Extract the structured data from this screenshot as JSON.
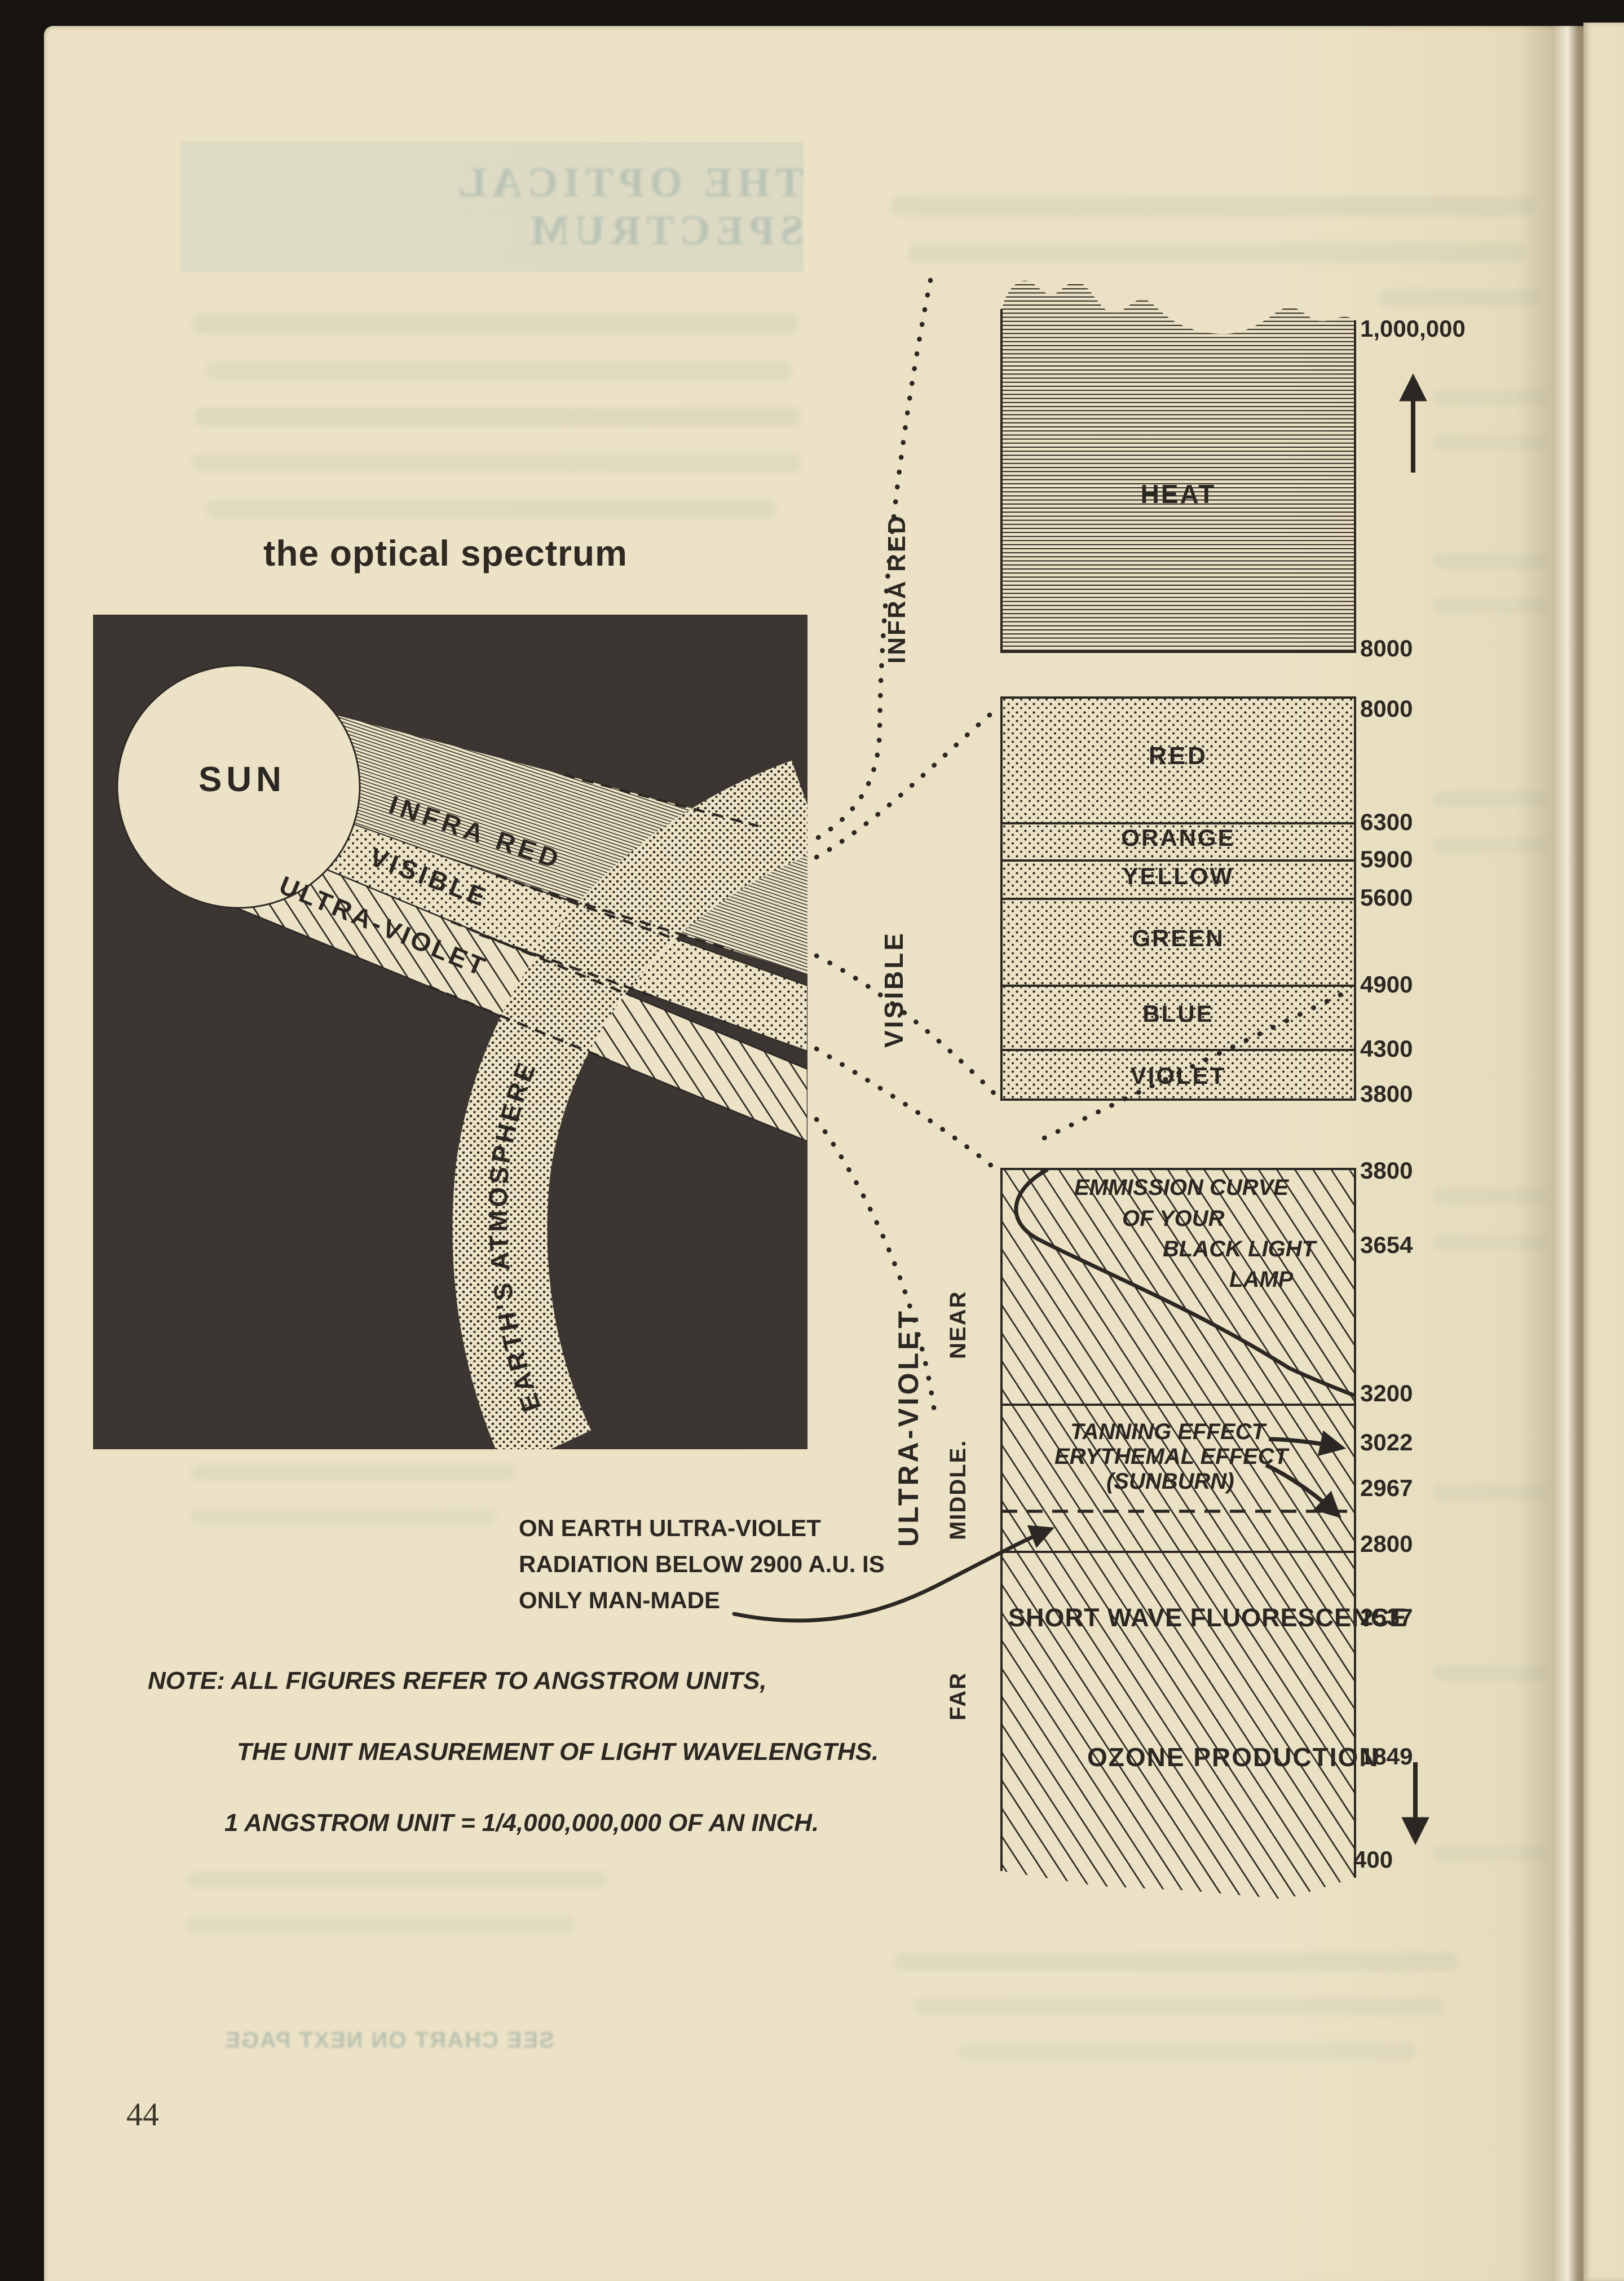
{
  "page": {
    "number": "44",
    "title": "the optical spectrum",
    "bleed_title": "THE OPTICAL SPECTRUM",
    "bleed_footer": "SEE CHART ON NEXT PAGE"
  },
  "diagram": {
    "sun": "SUN",
    "infra_red": "INFRA RED",
    "visible": "VISIBLE",
    "ultra_violet": "ULTRA-VIOLET",
    "atmosphere": "EARTH'S ATMOSPHERE"
  },
  "chart": {
    "heat_label": "HEAT",
    "side_labels": {
      "infra_red": "INFRA RED",
      "visible": "VISIBLE",
      "ultra_violet": "ULTRA-VIOLET",
      "near": "NEAR",
      "middle": "MIDDLE.",
      "far": "FAR"
    },
    "color_labels": [
      "RED",
      "ORANGE",
      "YELLOW",
      "GREEN",
      "BLUE",
      "VIOLET"
    ],
    "emission_curve_lines": [
      "EMMISSION CURVE",
      "OF YOUR",
      "BLACK LIGHT",
      "LAMP"
    ],
    "tanning_label": "TANNING EFFECT",
    "erythemal_label": "ERYTHEMAL EFFECT",
    "sunburn_label": "(SUNBURN)",
    "short_wave_label": "SHORT WAVE FLUORESCENCE",
    "ozone_label": "OZONE PRODUCTION",
    "ticks": {
      "max": "1,000,000",
      "ir_bottom": "8000",
      "vis_top": "8000",
      "red_orange": "6300",
      "orange_yellow": "5900",
      "yellow_green": "5600",
      "green_blue": "4900",
      "blue_violet": "4300",
      "vis_bottom": "3800",
      "uv_top": "3800",
      "black_light": "3654",
      "near_bottom": "3200",
      "tanning": "3022",
      "erythemal": "2967",
      "middle_bottom": "2800",
      "fluorescence": "2537",
      "ozone": "1849",
      "min": "400"
    }
  },
  "notes": {
    "uv_lines": [
      "ON EARTH ULTRA-VIOLET",
      "RADIATION BELOW 2900 A.U. IS",
      "ONLY MAN-MADE"
    ],
    "note_lines": [
      "NOTE: ALL FIGURES REFER TO ANGSTROM UNITS,",
      "THE UNIT MEASUREMENT OF LIGHT WAVELENGTHS.",
      "1 ANGSTROM UNIT = 1/4,000,000,000 OF AN INCH."
    ]
  },
  "colors": {
    "paper": "#ece3c6",
    "ink": "#2b2722",
    "dark_panel": "#3b3631",
    "scan_background": "#171411",
    "bleedthrough": "#7d9693"
  },
  "chart_data": {
    "type": "table",
    "title": "the optical spectrum",
    "unit": "Angstrom Units (A.U.)",
    "orientation": "vertical scale, wavelength decreasing downward",
    "bands": [
      {
        "band": "INFRA RED",
        "note": "HEAT",
        "from_au": 1000000,
        "to_au": 8000
      },
      {
        "band": "VISIBLE",
        "from_au": 8000,
        "to_au": 3800,
        "segments": [
          {
            "name": "RED",
            "from_au": 8000,
            "to_au": 6300
          },
          {
            "name": "ORANGE",
            "from_au": 6300,
            "to_au": 5900
          },
          {
            "name": "YELLOW",
            "from_au": 5900,
            "to_au": 5600
          },
          {
            "name": "GREEN",
            "from_au": 5600,
            "to_au": 4900
          },
          {
            "name": "BLUE",
            "from_au": 4900,
            "to_au": 4300
          },
          {
            "name": "VIOLET",
            "from_au": 4300,
            "to_au": 3800
          }
        ]
      },
      {
        "band": "ULTRA-VIOLET",
        "from_au": 3800,
        "to_au": 400,
        "zones": [
          {
            "name": "NEAR",
            "from_au": 3800,
            "to_au": 3200
          },
          {
            "name": "MIDDLE",
            "from_au": 3200,
            "to_au": 2800
          },
          {
            "name": "FAR",
            "from_au": 2800,
            "to_au": 400
          }
        ],
        "annotations": [
          {
            "label": "EMMISSION CURVE OF YOUR BLACK LIGHT LAMP",
            "at_au": 3654
          },
          {
            "label": "TANNING EFFECT",
            "at_au": 3022
          },
          {
            "label": "ERYTHEMAL EFFECT (SUNBURN)",
            "at_au": 2967
          },
          {
            "label": "man-made limit (dashed)",
            "at_au": 2900
          },
          {
            "label": "SHORT WAVE FLUORESCENCE",
            "at_au": 2537
          },
          {
            "label": "OZONE PRODUCTION",
            "at_au": 1849
          }
        ]
      }
    ]
  }
}
